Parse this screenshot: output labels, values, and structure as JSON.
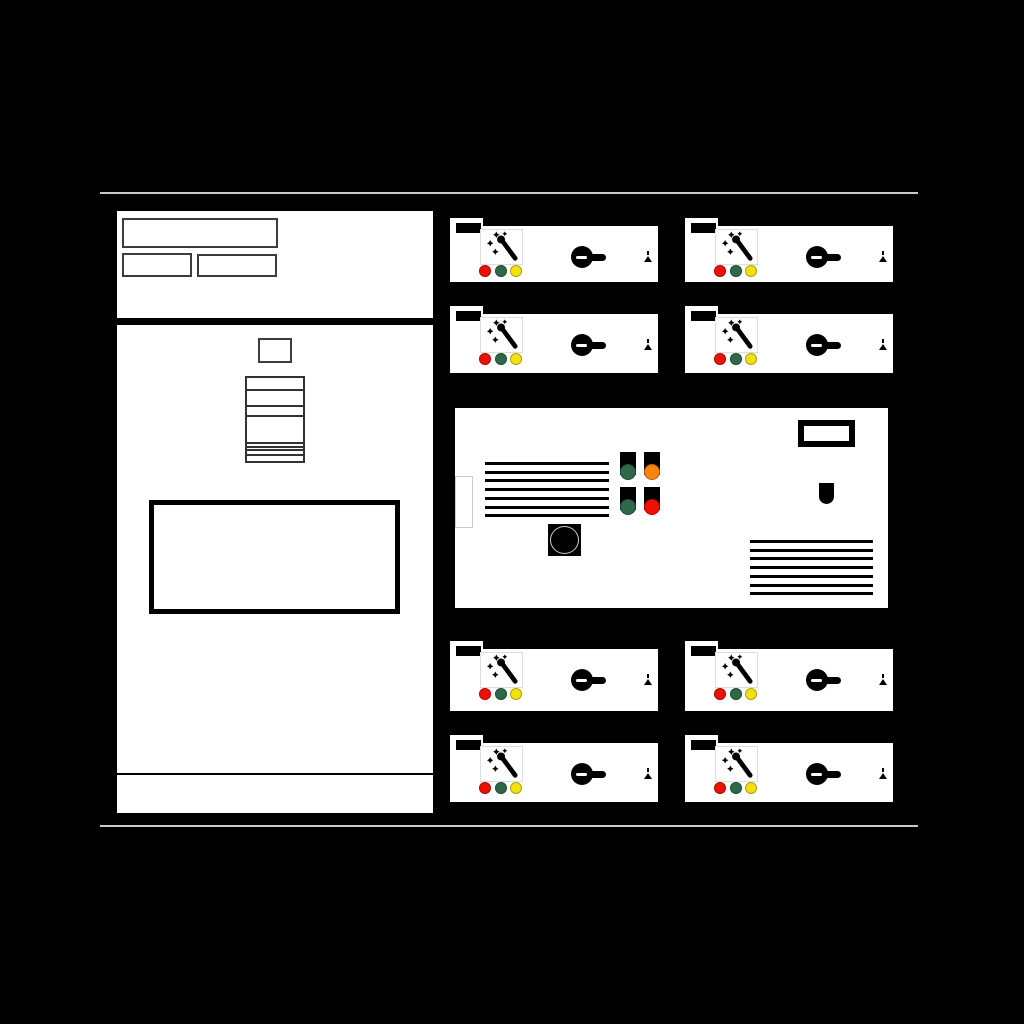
{
  "scene": {
    "name": "switchgear-front-elevation-drawing",
    "background": "#000000",
    "frame_lines": {
      "x": 100,
      "width": 818,
      "top_y": 192,
      "bottom_y": 825,
      "color": "#c8c8c8"
    }
  },
  "colors": {
    "panel": "#ffffff",
    "outline": "#000000",
    "red": "#ee1005",
    "green": "#2d684a",
    "yellow": "#f2e10e",
    "orange": "#f5830c"
  },
  "left_cabinet": {
    "x": 117,
    "y": 211,
    "w": 316,
    "h": 602,
    "nameplates": [
      {
        "x": 5,
        "y": 7,
        "w": 156,
        "h": 30
      },
      {
        "x": 5,
        "y": 42,
        "w": 70,
        "h": 24
      },
      {
        "x": 80,
        "y": 43,
        "w": 80,
        "h": 23
      }
    ],
    "divider": {
      "y": 107,
      "h": 7
    },
    "small_square": {
      "x": 141,
      "y": 127,
      "w": 34,
      "h": 25
    },
    "stack": {
      "x": 128,
      "y": 165,
      "w": 60,
      "h": 87,
      "lines": [
        {
          "off": 11,
          "h": 1.5
        },
        {
          "off": 27,
          "h": 1.5
        },
        {
          "off": 37,
          "h": 1.5
        },
        {
          "off": 64,
          "h": 2
        },
        {
          "off": 67.5,
          "h": 2
        },
        {
          "off": 71,
          "h": 2
        },
        {
          "off": 76,
          "h": 1.5
        }
      ]
    },
    "window": {
      "x": 32,
      "y": 289,
      "w": 251,
      "h": 114
    },
    "kick_divider": {
      "y": 562,
      "h": 2
    }
  },
  "control_panel": {
    "x": 455,
    "y": 408,
    "w": 433,
    "h": 200,
    "side_tab": {
      "x": 0,
      "y": 68,
      "w": 18,
      "h": 52
    },
    "left_louver": {
      "x": 30,
      "y": 54,
      "w": 124,
      "lines": 7,
      "pitch": 8.7,
      "thickness": 3
    },
    "right_louver": {
      "x": 295,
      "y": 132,
      "w": 123,
      "lines": 7,
      "pitch": 8.7,
      "thickness": 3
    },
    "display_window": {
      "x": 343,
      "y": 12,
      "w": 57,
      "h": 27
    },
    "keyhole": {
      "x": 364,
      "y": 75,
      "w": 15,
      "h": 21
    },
    "mushroom_button": {
      "x": 93,
      "y": 116,
      "w": 33,
      "h": 32
    },
    "pushbutton_grid": {
      "x": 165,
      "y": 44,
      "col_pitch": 24,
      "row_pitch": 35,
      "btn_w": 16,
      "btn_h": 23,
      "cap_d": 16
    },
    "pushbuttons": [
      {
        "col": 0,
        "row": 0,
        "color": "green"
      },
      {
        "col": 1,
        "row": 0,
        "color": "orange"
      },
      {
        "col": 0,
        "row": 1,
        "color": "green"
      },
      {
        "col": 1,
        "row": 1,
        "color": "red"
      }
    ]
  },
  "bay_template": {
    "w": 208,
    "lamps": [
      "red",
      "green",
      "yellow"
    ],
    "lamp_centers_x": [
      35,
      51,
      66
    ],
    "lamp_center_y": 45,
    "lamp_d": 12,
    "knob": {
      "x": 121,
      "y": 20
    },
    "tick": {
      "right": 9,
      "top": 25
    },
    "arrow": {
      "right": 6,
      "top": 30
    }
  },
  "bays": [
    {
      "id": "bay-a1",
      "x": 450,
      "y": 226,
      "h": 56
    },
    {
      "id": "bay-b1",
      "x": 685,
      "y": 226,
      "h": 56
    },
    {
      "id": "bay-a2",
      "x": 450,
      "y": 314,
      "h": 59
    },
    {
      "id": "bay-b2",
      "x": 685,
      "y": 314,
      "h": 59
    },
    {
      "id": "bay-a3",
      "x": 450,
      "y": 649,
      "h": 62
    },
    {
      "id": "bay-b3",
      "x": 685,
      "y": 649,
      "h": 62
    },
    {
      "id": "bay-a4",
      "x": 450,
      "y": 743,
      "h": 59
    },
    {
      "id": "bay-b4",
      "x": 685,
      "y": 743,
      "h": 59
    }
  ]
}
